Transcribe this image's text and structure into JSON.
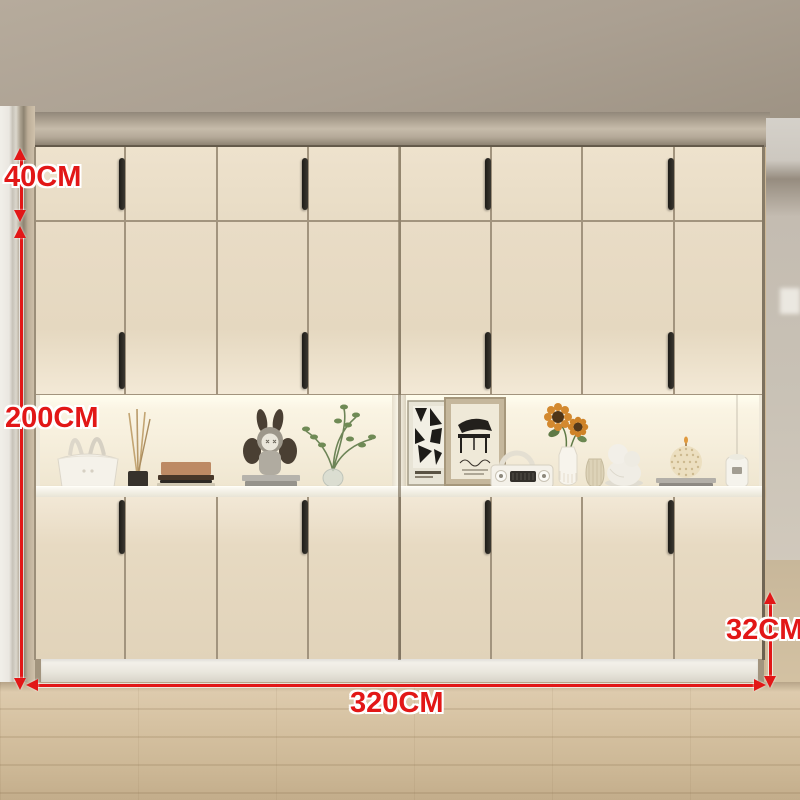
{
  "annotations": {
    "top_section_height": {
      "label": "40CM"
    },
    "total_height": {
      "label": "200CM"
    },
    "total_width": {
      "label": "320CM"
    },
    "depth": {
      "label": "32CM"
    }
  },
  "wardrobe": {
    "doors_per_row": 8,
    "handle_door_indices": [
      0,
      2,
      4,
      6
    ],
    "rows": [
      "top-cabinets",
      "tall-doors",
      "lower-cabinets"
    ],
    "open_shelf_sections": 2
  },
  "shelf_display": {
    "left_items": [
      "handbag",
      "reed-diffuser",
      "book-stack",
      "bunny-figurine",
      "plant-in-vase"
    ],
    "right_items": [
      "abstract-poster",
      "piano-artwork",
      "retro-radio",
      "sunflower-vase",
      "striped-vase",
      "cherub-figurine",
      "sphere-candle",
      "ceramic-jar"
    ]
  },
  "colors": {
    "accent_red": "#e21717",
    "door_beige": "#e8dcc5",
    "seam": "#a2947e",
    "handle_black": "#26241f",
    "niche_cream": "#f7f0dd",
    "ceiling_taupe": "#aba092",
    "floor_wood": "#d2bd9e",
    "plinth_white": "#efede6"
  }
}
